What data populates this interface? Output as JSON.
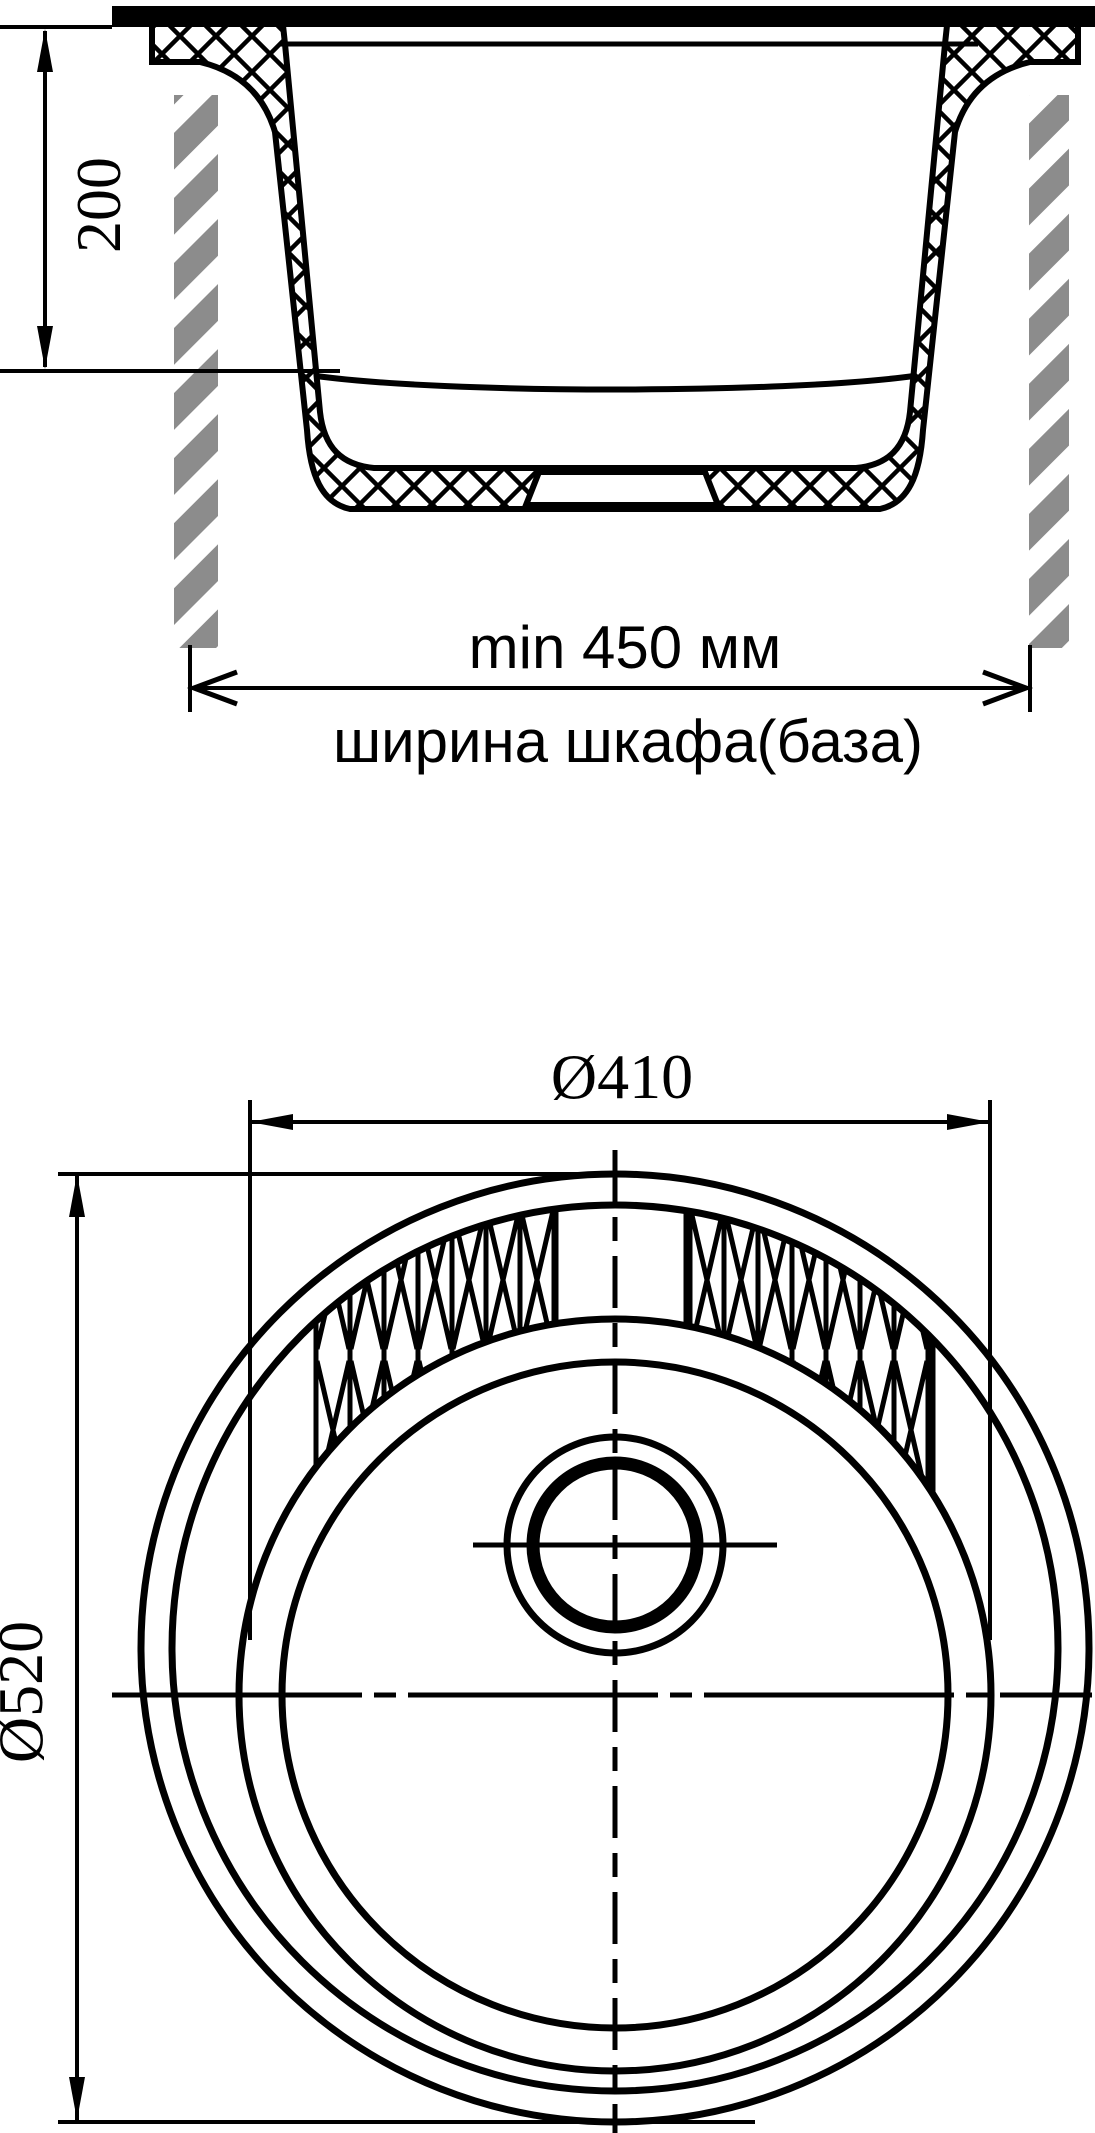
{
  "drawing": {
    "type": "sink installation drawing",
    "views": {
      "section_view": {
        "depth_dim": {
          "value": "200",
          "unit": "mm",
          "meaning": "sink bowl depth"
        },
        "cabinet_width_dim": {
          "value": "min 450 мм",
          "label": "ширина шкафа(база)",
          "meaning": "minimum base cabinet width"
        }
      },
      "top_view": {
        "bowl_diameter_dim": {
          "value": "Ø410",
          "unit": "mm",
          "meaning": "bowl diameter"
        },
        "overall_diameter_dim": {
          "value": "Ø520",
          "unit": "mm",
          "meaning": "overall sink diameter"
        }
      }
    }
  },
  "colors": {
    "line": "#000000",
    "background": "#ffffff",
    "cabinet_gray": "#8c8c8c",
    "cabinet_stripe": "#ffffff"
  }
}
